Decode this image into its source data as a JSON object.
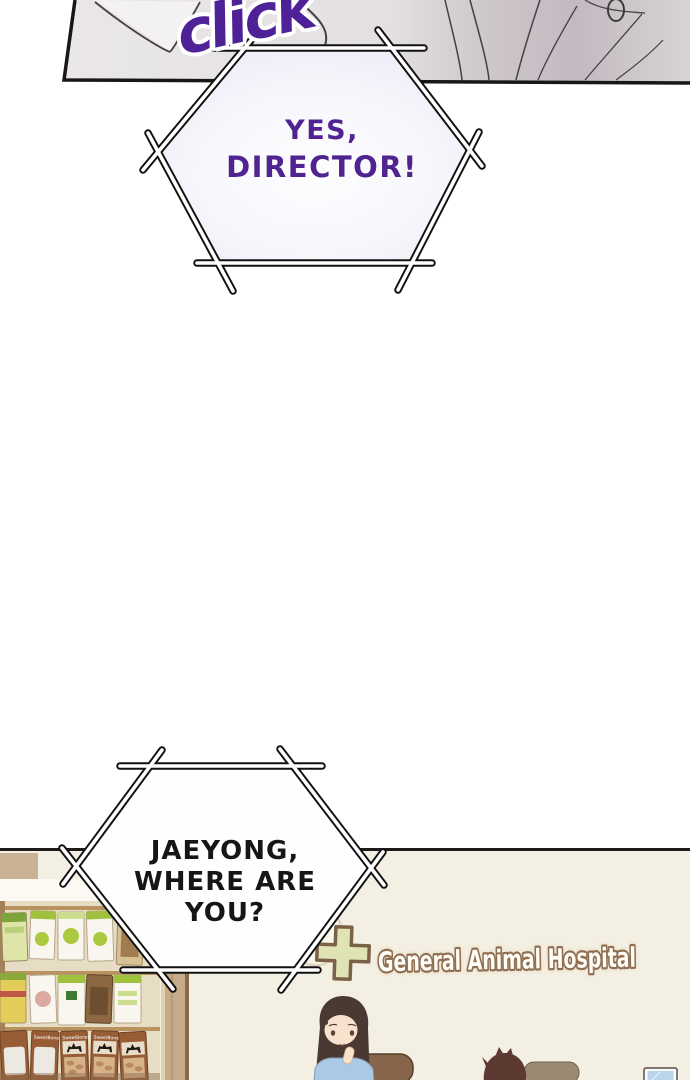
{
  "page": {
    "sfx_click": "click",
    "bubble_yes": {
      "line1": "YES,",
      "line2": "DIRECTOR!"
    },
    "bubble_jaeyong": {
      "line1": "JAEYONG,",
      "line2": "WHERE ARE YOU?"
    },
    "scene": {
      "hospital_sign": "General Animal Hospital",
      "shelf_brand": "SweetBones"
    },
    "colors": {
      "sfx_purple": "#4e2296",
      "dialogue_purple": "#4f2491",
      "dialogue_black": "#161616",
      "bubble_outline": "#111111",
      "bubble1_fill": "#edebf6",
      "scene_background": "#f3efe2",
      "sign_fill": "#fffdf6",
      "sign_outline": "#8f7054",
      "cross_fill": "#e0e3b3",
      "cross_outline": "#7a6147",
      "shelf_wood": "#c6ab89",
      "treat_green": "#9fc13d",
      "treat_brown": "#995d36",
      "woman_shirt_blue": "#a9c9e5",
      "chair_brown": "#86654a",
      "monitor_blue": "#b9d5eb"
    }
  }
}
